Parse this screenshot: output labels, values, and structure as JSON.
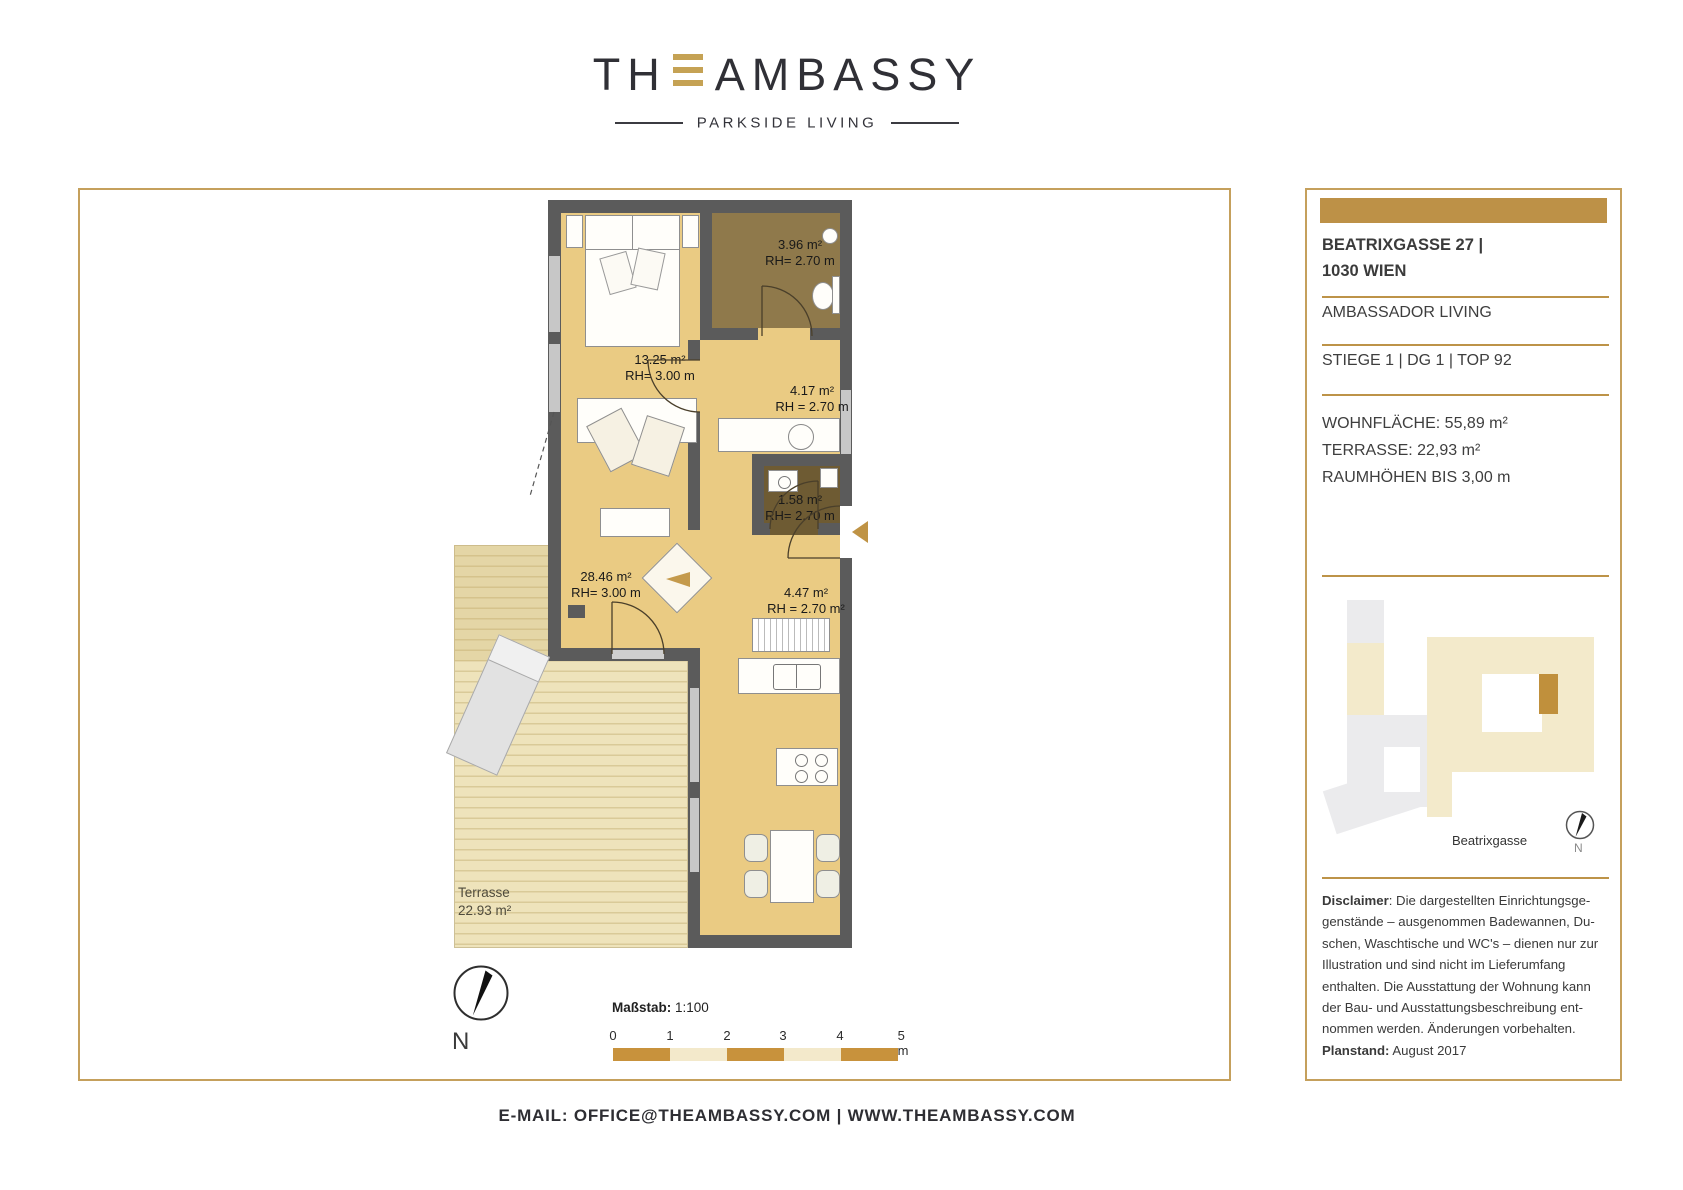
{
  "logo": {
    "word_start": "TH",
    "word_end": "AMBASSY",
    "tagline": "PARKSIDE LIVING"
  },
  "colors": {
    "accent_gold": "#BD9147",
    "border_gold": "#C5A05C",
    "room_tan": "#EACB83",
    "bath_brown": "#8F794B",
    "wc_brown": "#6E5B33",
    "wall_gray": "#5B5B5B",
    "scale_gold": "#C8923C",
    "scale_cream": "#F3E9CB"
  },
  "plan": {
    "rooms": [
      {
        "id": "bath-top",
        "area": "3.96 m²",
        "rh": "RH= 2.70 m"
      },
      {
        "id": "bedroom",
        "area": "13.25 m²",
        "rh": "RH= 3.00 m"
      },
      {
        "id": "bathroom",
        "area": "4.17 m²",
        "rh": "RH = 2.70 m"
      },
      {
        "id": "wc",
        "area": "1.58 m²",
        "rh": "RH= 2.70 m"
      },
      {
        "id": "living",
        "area": "28.46 m²",
        "rh": "RH= 3.00 m"
      },
      {
        "id": "corridor",
        "area": "4.47 m²",
        "rh": "RH = 2.70 m²"
      }
    ],
    "terrace": {
      "name": "Terrasse",
      "area": "22.93 m²"
    },
    "north_label": "N",
    "scale_label": "Maßstab:",
    "scale_value": "1:100",
    "scale_ticks": [
      "0",
      "1",
      "2",
      "3",
      "4",
      "5 m"
    ]
  },
  "sidebar": {
    "address_line1": "BEATRIXGASSE 27 |",
    "address_line2": "1030 WIEN",
    "project": "AMBASSADOR LIVING",
    "unit": "STIEGE 1 | DG 1 | TOP 92",
    "stats": [
      "WOHNFLÄCHE: 55,89 m²",
      "TERRASSE: 22,93 m²",
      "RAUMHÖHEN BIS 3,00 m"
    ],
    "siteplan": {
      "street_label": "Beatrixgasse",
      "north_label": "N"
    },
    "disclaimer_label": "Disclaimer",
    "disclaimer_line1_rest": ": Die dargestellten Einrichtungsge-",
    "disclaimer_lines": [
      "genstände – ausgenommen Badewannen, Du-",
      "schen, Waschtische und WC's – dienen nur zur",
      "Illustration und sind nicht im Lieferumfang",
      "enthalten. Die Ausstattung der Wohnung kann",
      "der Bau- und Ausstattungsbeschreibung ent-",
      "nommen werden. Änderungen vorbehalten."
    ],
    "planstand_label": "Planstand:",
    "planstand_value": "August 2017"
  },
  "footer": {
    "contact": "E-MAIL: OFFICE@THEAMBASSY.COM | WWW.THEAMBASSY.COM"
  }
}
